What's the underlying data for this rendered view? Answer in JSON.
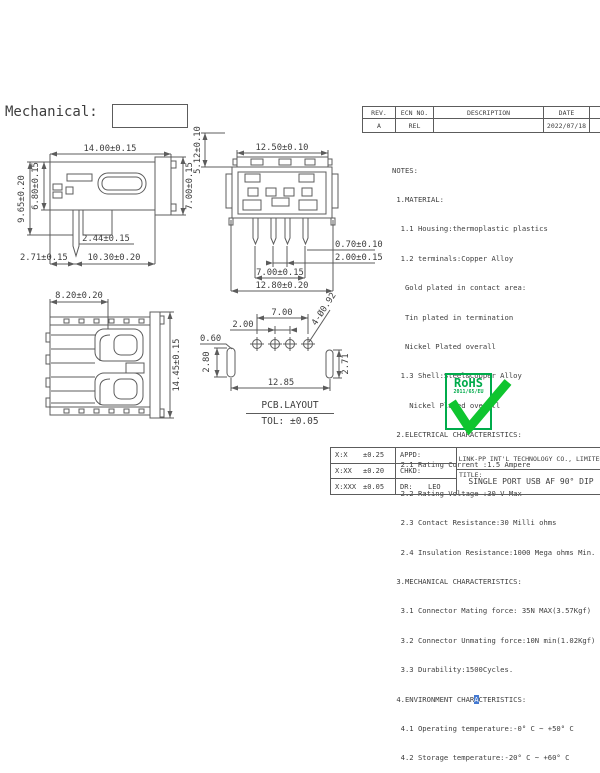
{
  "page": {
    "section_label": "Mechanical:"
  },
  "colors": {
    "line": "#5c5c5c",
    "text": "#3e3e3e",
    "green": "#00ab4b",
    "check_green": "#0fc52f",
    "highlight_blue": "#4479d1"
  },
  "revision_table": {
    "headers": {
      "rev": "REV.",
      "ecn": "ECN NO.",
      "description": "DESCRIPTION",
      "date": "DATE",
      "appd": "APPD"
    },
    "row": {
      "rev": "A",
      "ecn": "REL",
      "description": "",
      "date": "2022/07/18",
      "appd": ""
    }
  },
  "notes": {
    "lines": [
      "NOTES:",
      " 1.MATERIAL:",
      "  1.1 Housing:thermoplastic plastics",
      "  1.2 terminals:Copper Alloy",
      "   Gold plated in contact area:",
      "   Tin plated in termination",
      "   Nickel Plated overall",
      "  1.3 Shell:Steel&Copper Alloy",
      "    Nickel Plated overall",
      " 2.ELECTRICAL CHARACTERISTICS:",
      "  2.1 Rating Current :1.5 Ampere",
      "  2.2 Rating Voltage :30 V Max",
      "  2.3 Contact Resistance:30 Milli ohms",
      "  2.4 Insulation Resistance:1000 Mega ohms Min.",
      " 3.MECHANICAL CHARACTERISTICS:",
      "  3.1 Connector Mating force: 35N MAX(3.57Kgf)",
      "  3.2 Connector Unmating force:10N min(1.02Kgf)",
      "  3.3 Durability:1500Cycles."
    ],
    "env_line": {
      "pre": " 4.ENVIRONMENT CHAR",
      "highlight": "A",
      "post": "CTERISTICS:"
    },
    "tail_lines": [
      "  4.1 Operating temperature:-0° C ~ +50° C",
      "  4.2 Storage temperature:-20° C ~ +60° C"
    ]
  },
  "side_view": {
    "width_top": "14.00±0.15",
    "height_outer_left": "9.65±0.20",
    "height_inner_left": "6.80±0.15",
    "height_right": "7.00±0.15",
    "pin_width": "2.44±0.15",
    "pin_offset": "2.71±0.15",
    "depth_bottom": "10.30±0.20"
  },
  "front_view": {
    "width_top": "12.50±0.10",
    "height_left": "5.12±0.10",
    "pin_width": "0.70±0.10",
    "pin_pitch": "2.00±0.15",
    "pin_span": "7.00±0.15",
    "width_bottom": "12.80±0.20"
  },
  "top_view": {
    "depth_top": "8.20±0.20",
    "width_right": "14.45±0.15"
  },
  "pcb_layout": {
    "hole_span": "7.00",
    "hole_pitch": "2.00",
    "hole_note": "4-Ø0.92",
    "slot_width": "0.60",
    "slot_height": "2.80",
    "right_slot_height": "2.71",
    "total_width": "12.85",
    "caption": "PCB.LAYOUT",
    "tolerance": "TOL: ±0.05"
  },
  "rohs": {
    "label": "RoHS",
    "directive": "2011/65/EU"
  },
  "title_block": {
    "tolerances": [
      {
        "label": "X:X",
        "value": "±0.25"
      },
      {
        "label": "X:XX",
        "value": "±0.20"
      },
      {
        "label": "X:XXX",
        "value": "±0.05"
      }
    ],
    "approvals": [
      {
        "label": "APPD:",
        "value": ""
      },
      {
        "label": "CHKD:",
        "value": ""
      },
      {
        "label": "DR:",
        "value": "LEO"
      }
    ],
    "company": "LINK-PP INT'L TECHNOLOGY CO., LIMITED",
    "title_label": "TITLE:",
    "title": "SINGLE PORT USB AF 90° DIP"
  }
}
